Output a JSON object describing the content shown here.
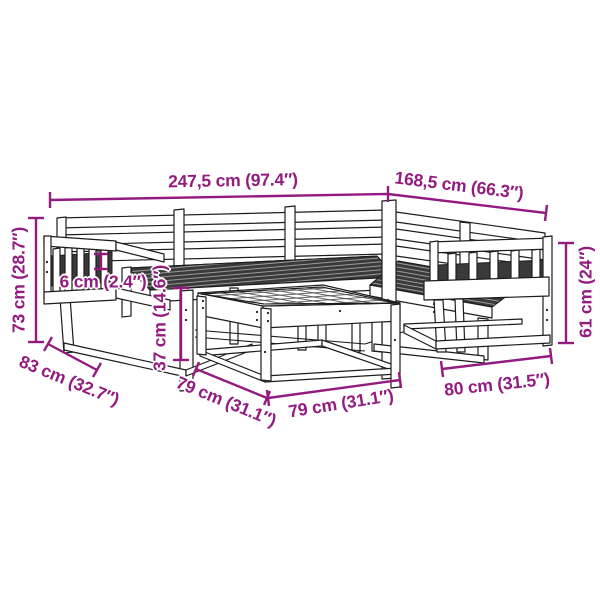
{
  "figure": {
    "type": "product-dimension-diagram",
    "subject": "garden lounge furniture set line drawing (corner sofa sections with slatted backrests, two armrests and low slatted tables)",
    "accent_color": "#931b80",
    "line_color": "#1c1c1c",
    "background_color": "#ffffff"
  },
  "dimensions": {
    "total_width": "247,5 cm (97.4″)",
    "total_depth": "168,5 cm (66.3″)",
    "back_height": "73 cm (28.7″)",
    "armrest_thickness": "6 cm (2.4″)",
    "table_height": "37 cm (14.6″)",
    "left_seat_depth": "83 cm (32.7″)",
    "table_depth": "79 cm (31.1″)",
    "table_width": "79 cm (31.1″)",
    "right_seat_width": "80 cm (31.5″)",
    "right_arm_height": "61 cm (24″)"
  }
}
